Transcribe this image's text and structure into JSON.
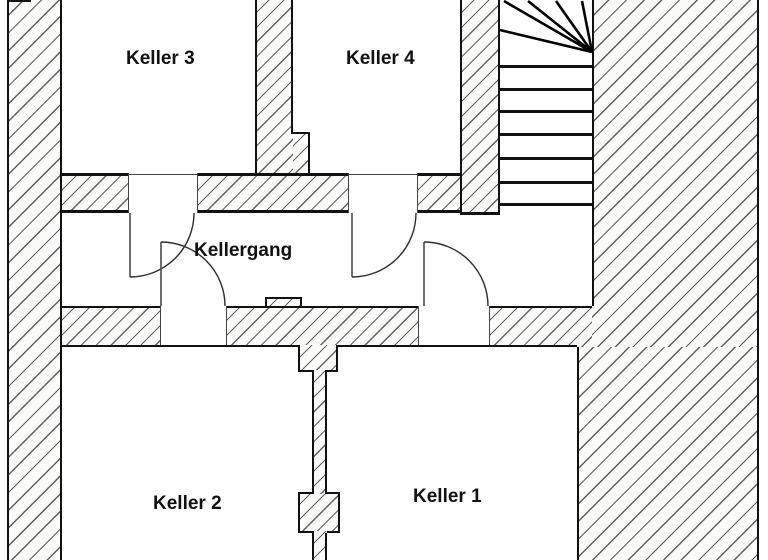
{
  "plan": {
    "rooms": {
      "keller3": "Keller 3",
      "keller4": "Keller 4",
      "kellergang": "Kellergang",
      "keller2": "Keller 2",
      "keller1": "Keller 1"
    },
    "colors": {
      "wall_line": "#111111",
      "hatch_line": "#3d3d3d",
      "hatch_bg": "#fbfbf9",
      "background": "#ffffff",
      "text": "#111111"
    }
  }
}
